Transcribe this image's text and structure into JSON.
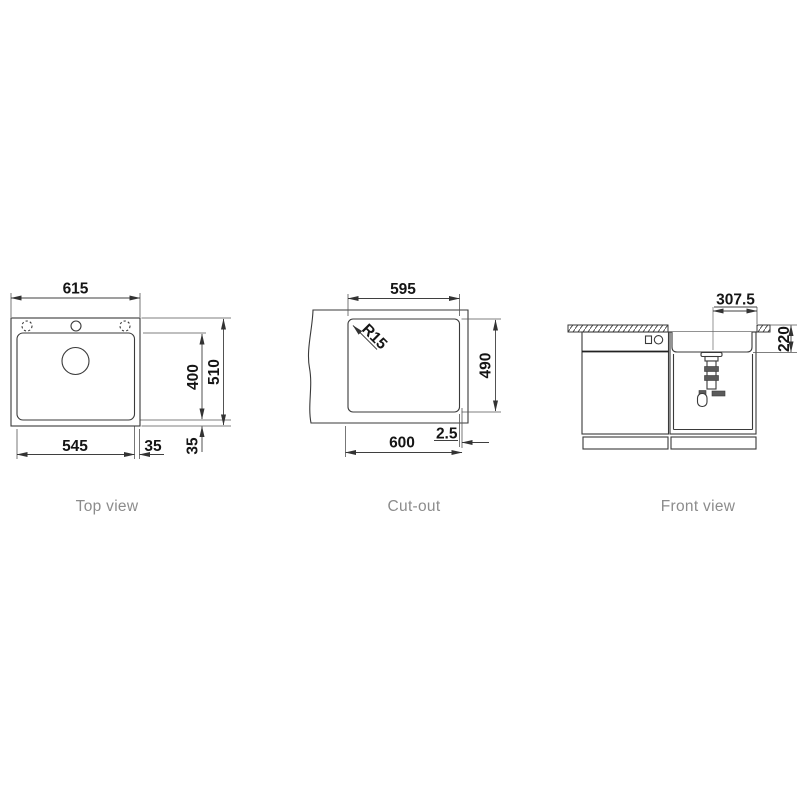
{
  "meta": {
    "background_color": "#ffffff",
    "line_color": "#3a3a3a",
    "dim_text_color": "#151515",
    "label_color": "#8c8c8c"
  },
  "views": {
    "top": {
      "label": "Top view",
      "dims": {
        "overall_width": "615",
        "overall_depth": "510",
        "bowl_width": "545",
        "bowl_depth": "400",
        "offset_right": "35",
        "offset_bottom": "35"
      }
    },
    "cutout": {
      "label": "Cut-out",
      "dims": {
        "width_top": "595",
        "depth": "490",
        "width_bottom": "600",
        "edge_offset": "2.5",
        "corner_radius": "R15"
      }
    },
    "front": {
      "label": "Front view",
      "dims": {
        "drain_to_edge": "307.5",
        "bowl_depth": "220"
      }
    }
  }
}
